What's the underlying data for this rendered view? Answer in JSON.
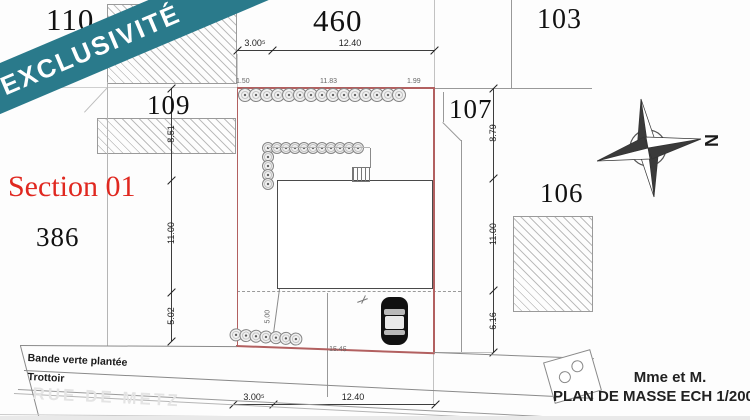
{
  "banner": {
    "label": "EXCLUSIVITÉ"
  },
  "section": {
    "label": "Section 01"
  },
  "parcels": {
    "n110": "110",
    "n460": "460",
    "n103": "103",
    "n109": "109",
    "n107": "107",
    "n106": "106",
    "n386": "386"
  },
  "dimensions": {
    "top": {
      "a": "3.00⁵",
      "b": "12.40"
    },
    "bottom": {
      "a": "3.00⁵",
      "b": "12.40"
    },
    "left": {
      "a": "8.51",
      "b": "11.00",
      "c": "5.02"
    },
    "right": {
      "a": "8.79",
      "b": "11.00",
      "c": "6.16"
    },
    "minor": {
      "tree_left": "1.50",
      "tree_mid": "11.83",
      "tree_right": "1.99",
      "frontage": "15.45",
      "path": "5.00"
    }
  },
  "road": {
    "green_band": "Bande verte plantée",
    "sidewalk": "Trottoir",
    "street": "RUE DE METZ"
  },
  "titleblock": {
    "owner": "Mme et M.",
    "plan": "PLAN DE MASSE ECH 1/200"
  },
  "compass": {
    "north": "N"
  },
  "colors": {
    "banner": "#2a7a8b",
    "boundary": "#b26060",
    "section_text": "#e02820"
  }
}
